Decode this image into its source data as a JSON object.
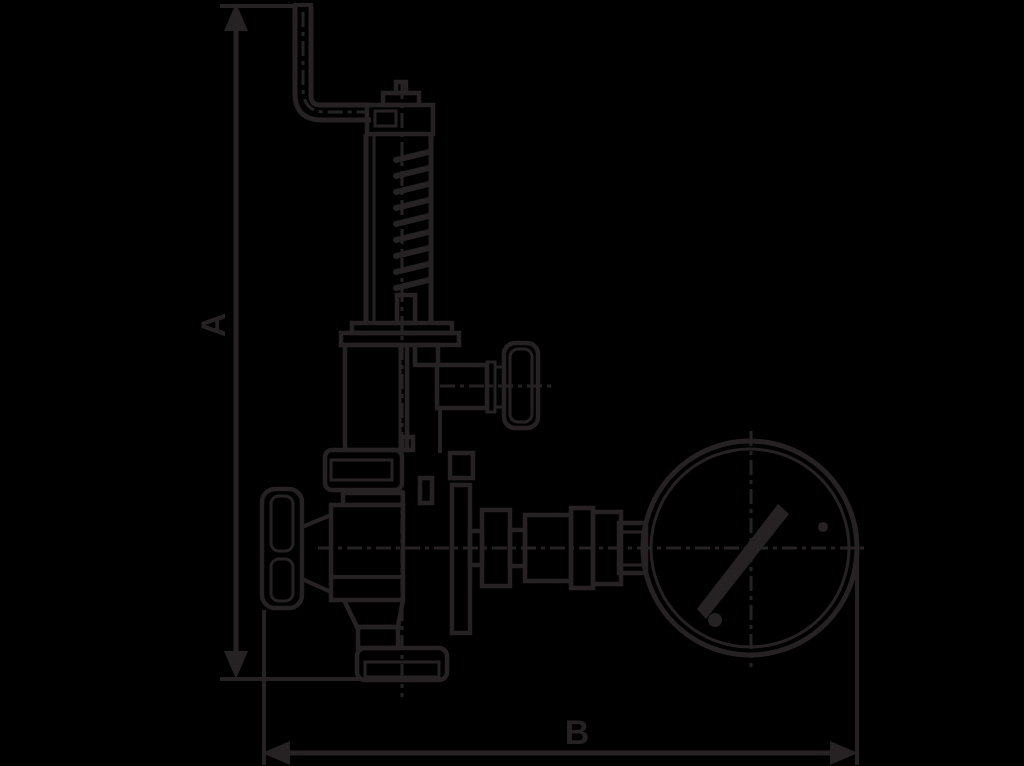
{
  "figure": {
    "type": "dimensioned-technical-line-drawing",
    "subject": "relief valve with bent lever pipe, spring housing, side handwheel and pressure gauge",
    "colors": {
      "background": "#000000",
      "ink": "#262223"
    },
    "dimensions": {
      "vertical_label": "A",
      "horizontal_label": "B"
    }
  }
}
